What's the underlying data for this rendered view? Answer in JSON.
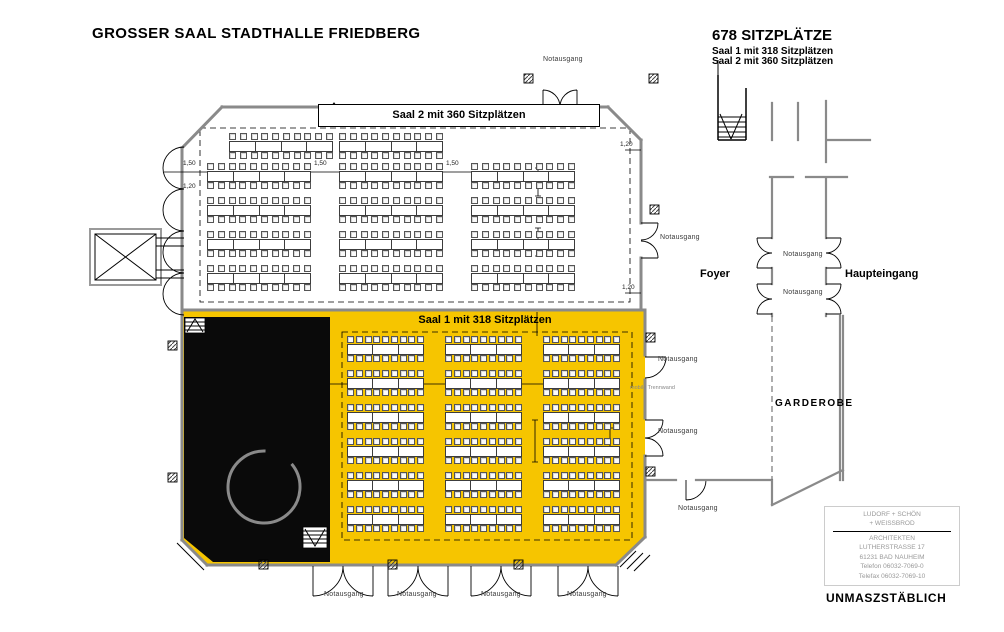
{
  "title": "GROSSER SAAL STADTHALLE FRIEDBERG",
  "summary": {
    "total": "678 SITZPLÄTZE",
    "line1": "Saal  1 mit 318 Sitzplätzen",
    "line2": "Saal  2 mit 360 Sitzplätzen"
  },
  "banners": {
    "saal2": "Saal 2 mit 360 Sitzplätzen",
    "saal1": "Saal 1 mit 318 Sitzplätzen"
  },
  "rooms": {
    "foyer": "Foyer",
    "haupteingang": "Haupteingang",
    "garderobe": "GARDEROBE"
  },
  "labels": {
    "notausgang": "Notausgang",
    "mobile_trennwand": "mobile Trennwand",
    "unmassstaeblich": "UNMASZSTÄBLICH"
  },
  "dimensions": {
    "d150": "1,50",
    "d120": "1,20"
  },
  "architect": {
    "name1": "LUDORF + SCHÖN",
    "name2": "+ WEISSBROD",
    "role": "ARCHITEKTEN",
    "street": "LUTHERSTRASSE 17",
    "city": "61231 BAD NAUHEIM",
    "phone": "Telefon   06032-7069-0",
    "fax": "Telefax  06032-7069-10"
  },
  "colors": {
    "saal1_fill": "#F6C500",
    "stage_fill": "#0a0a0a",
    "wall_gray": "#8a8a8a"
  }
}
